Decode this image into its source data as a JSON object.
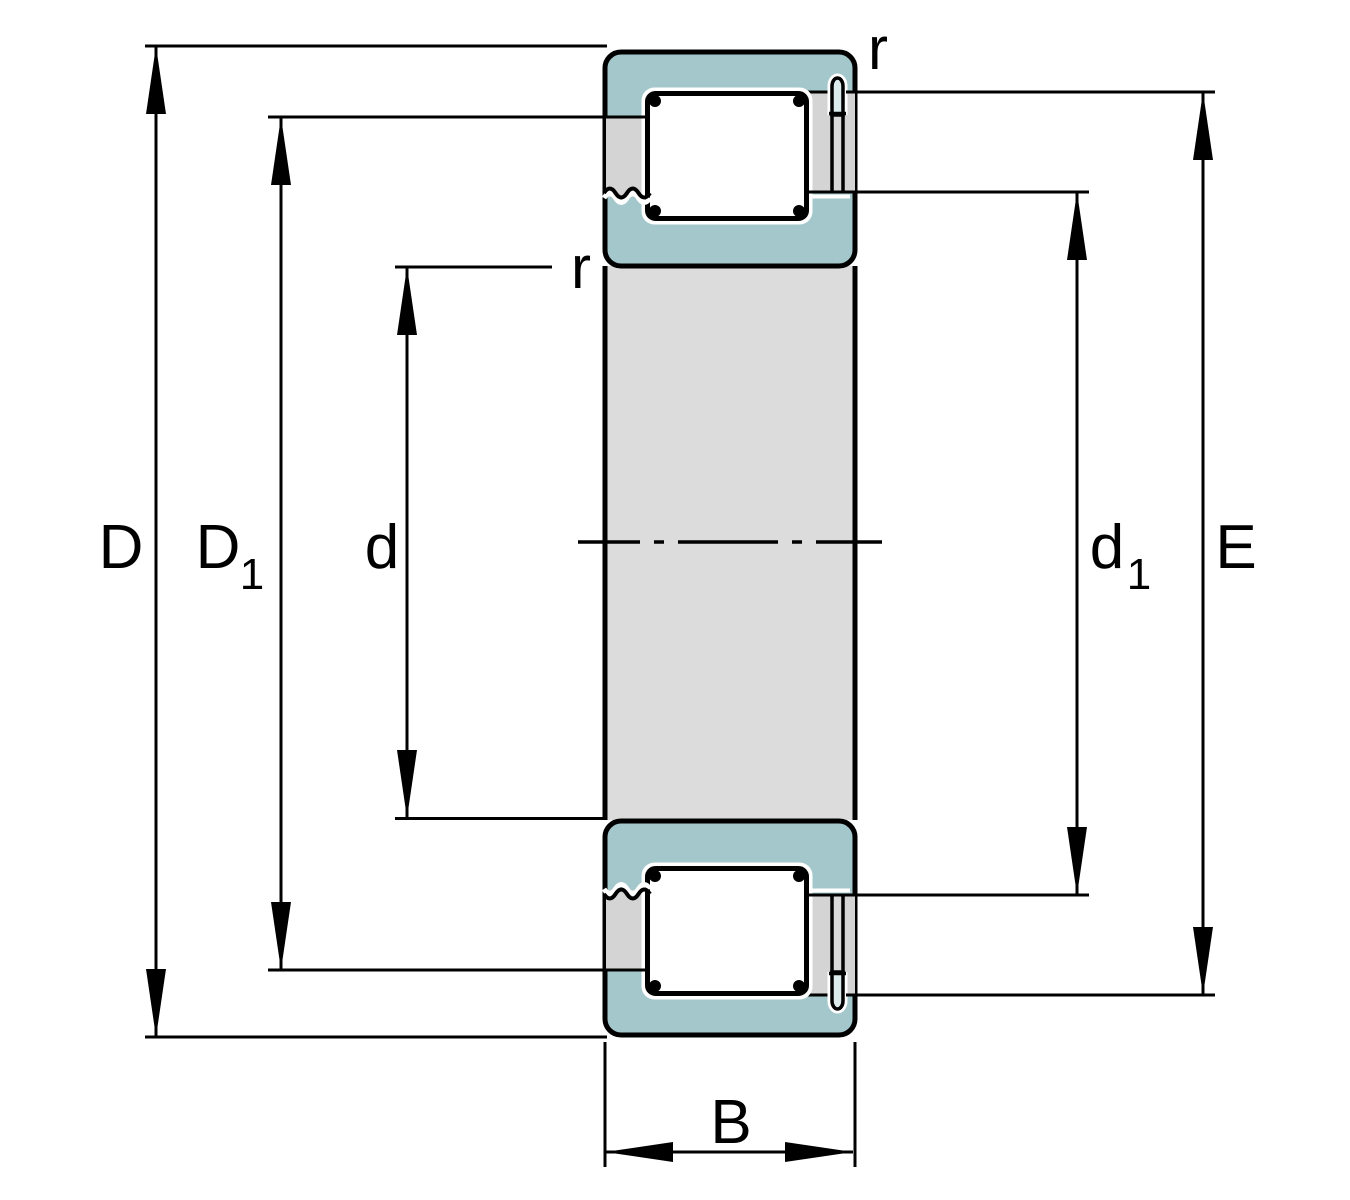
{
  "labels": {
    "dim_D": "D",
    "dim_D1_main": "D",
    "dim_D1_sub": "1",
    "dim_d": "d",
    "dim_d1_main": "d",
    "dim_d1_sub": "1",
    "dim_E": "E",
    "dim_B": "B",
    "fillet_r_top": "r",
    "fillet_r_inner": "r"
  },
  "colors": {
    "ring-teal": "#a3c7cb",
    "cage-gray": "#d4d4d4",
    "bore-gray": "#dcdcdc",
    "pin-slot-gray": "#d9d9d9",
    "pin-cap": "#dcebec",
    "roller-dark": "#82b0b6",
    "roller-light": "#ffffff",
    "roller-end": "#9fc5c9",
    "line-black": "#000000",
    "background": "#ffffff"
  }
}
